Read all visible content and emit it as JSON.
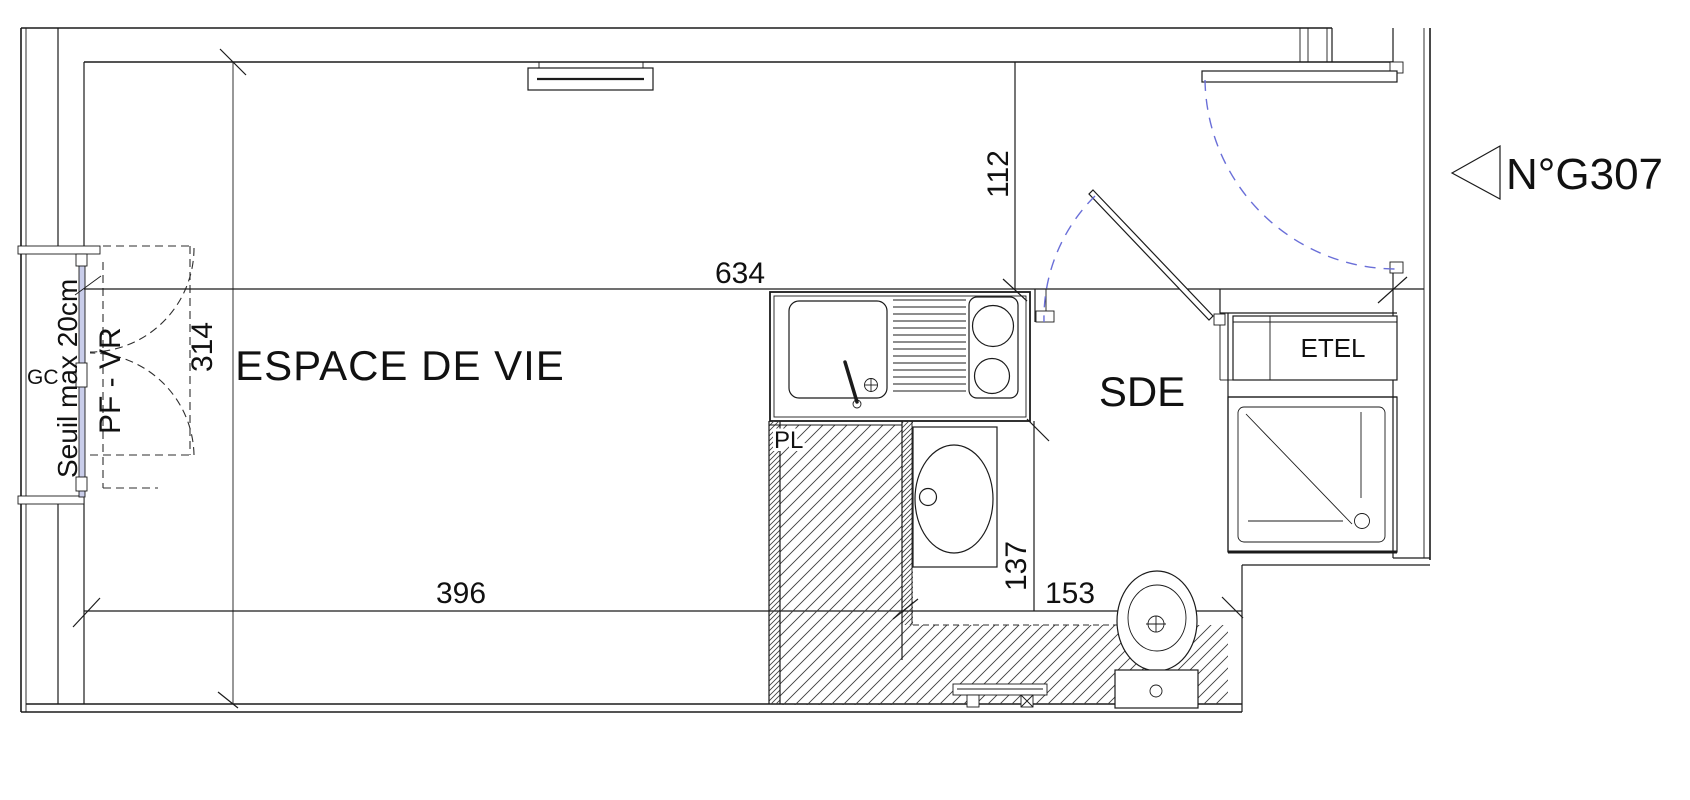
{
  "plan": {
    "unit": {
      "label": "N°G307"
    },
    "rooms": {
      "living": {
        "name": "ESPACE DE VIE"
      },
      "shower_room": {
        "name": "SDE"
      },
      "closet": {
        "name": "PL"
      },
      "utility": {
        "name": "ETEL"
      }
    },
    "window_annotations": {
      "gc": "GC",
      "threshold": "Seuil max 20cm",
      "window_type": "PF - VR"
    },
    "dimensions_cm": {
      "living_length": "634",
      "living_width": "314",
      "living_bottom": "396",
      "entry_depth": "112",
      "sde_depth": "137",
      "sde_width": "153"
    },
    "colors": {
      "ink": "#1b1b1b",
      "door_swing": "#6a6fd8",
      "glazing": "#c9cdea"
    }
  }
}
